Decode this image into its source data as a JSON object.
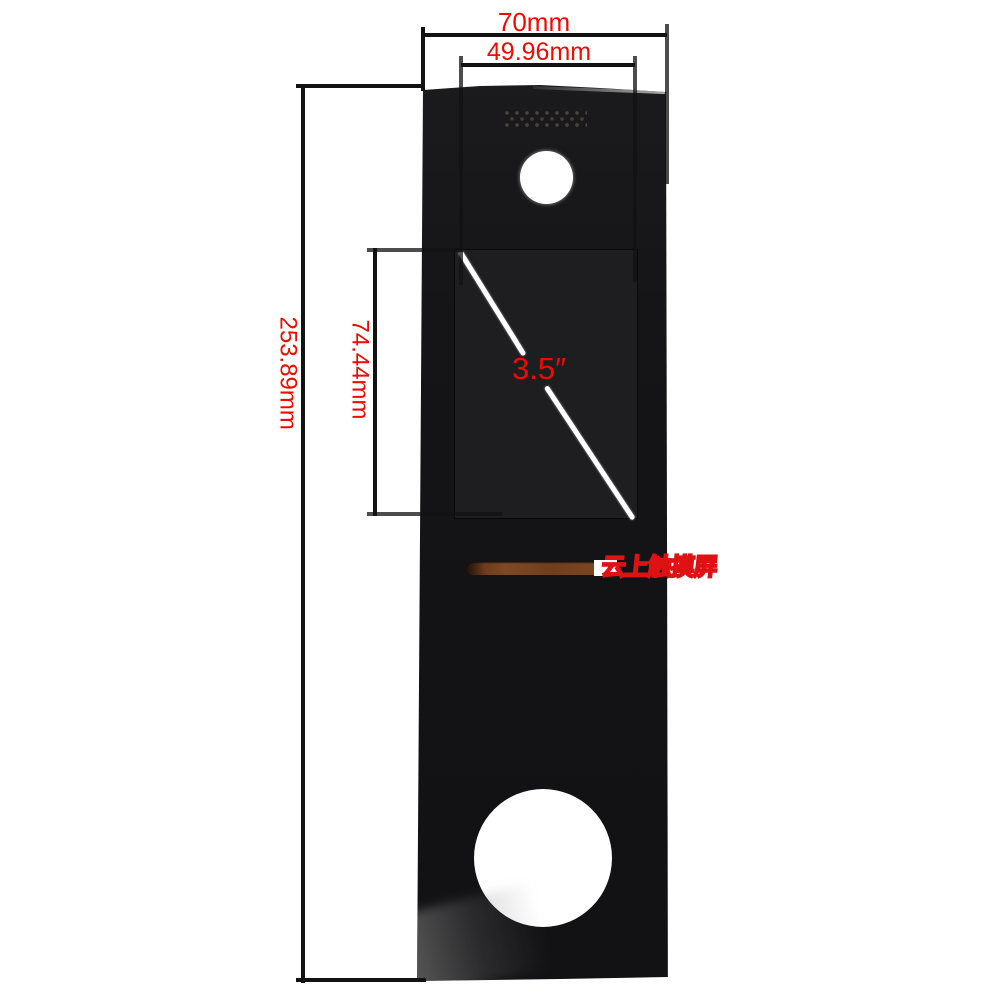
{
  "annotations": {
    "outer_width_label": "70mm",
    "inner_width_label": "49.96mm",
    "overall_height_label": "253.89mm",
    "screen_height_label": "74.44mm",
    "screen_diagonal_label": "3.5″"
  },
  "watermark": {
    "text": "云上触摸屏"
  },
  "colors": {
    "annotation_red": "#ee0b00",
    "dimension_line_black": "#121212",
    "panel_black": "#151517",
    "display_window_black": "#1e1e21",
    "slot_copper": "#7b4523",
    "watermark_red": "#de1212",
    "background_white": "#ffffff"
  }
}
